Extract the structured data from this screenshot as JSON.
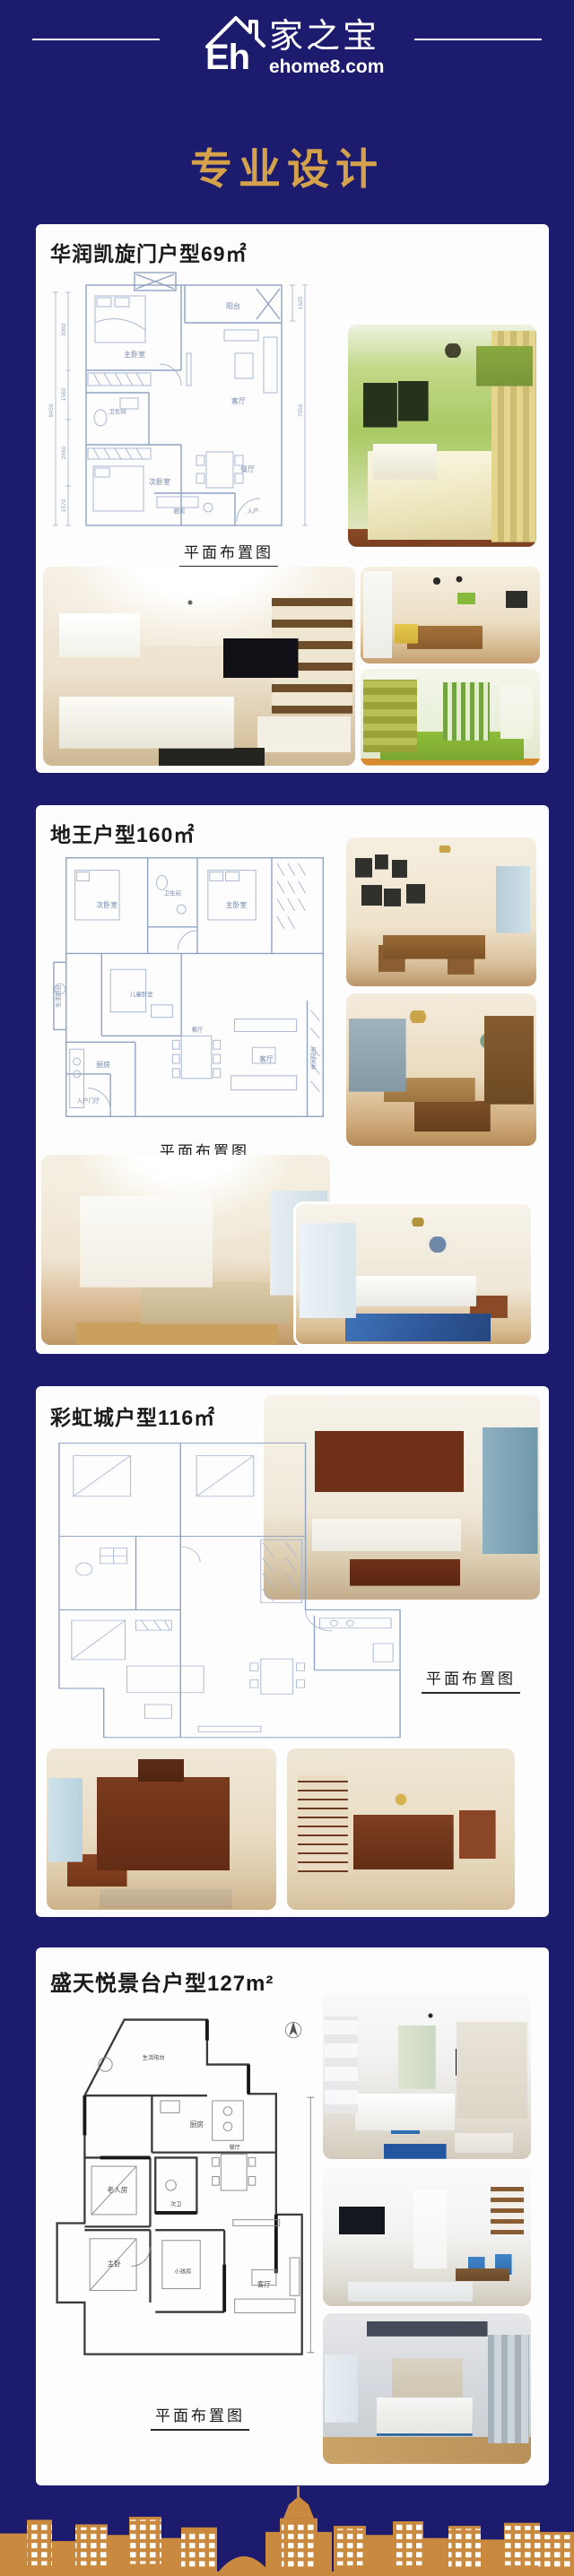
{
  "theme": {
    "bg": "#1c1b6e",
    "gold": "#d3a24b",
    "card": "#fdfdfe",
    "ink": "#1a1a1a",
    "plan": "#8fa2c2",
    "plan_ink": "#7487ab",
    "skyline": "#c9893e",
    "white": "#ffffff"
  },
  "header": {
    "roof_icon": "house-roof-icon",
    "brand_initials": "Eh",
    "brand_name": "家之宝",
    "brand_domain": "ehome8.com"
  },
  "page_title": "专业设计",
  "sections": [
    {
      "title": "华润凯旋门户型69㎡",
      "caption": "平面布置图",
      "plan_rooms": [
        "阳台",
        "主卧室",
        "客厅",
        "卫生间",
        "次卧室",
        "餐厅",
        "厨房",
        "入户"
      ],
      "plan_dims": [
        "9450",
        "3080",
        "1560",
        "2460",
        "1570",
        "1620",
        "7950"
      ],
      "photos": [
        "green-country-bedroom",
        "beige-living-room",
        "wood-dining-area",
        "green-study-room"
      ]
    },
    {
      "title": "地王户型160㎡",
      "caption": "平面布置图",
      "plan_rooms": [
        "次卧室",
        "卫生间",
        "主卧室",
        "儿童卧室",
        "生活阳台",
        "厨房",
        "餐厅",
        "客厅",
        "入户门厅",
        "休闲阳台"
      ],
      "photos": [
        "gallery-wall-dining",
        "wood-kitchen-dining",
        "cream-living-room",
        "blue-rug-lounge"
      ]
    },
    {
      "title": "彩虹城户型116㎡",
      "caption": "平面布置图",
      "plan_rooms": [],
      "photos": [
        "chinese-living-room",
        "redwood-tv-room",
        "redwood-dining-room"
      ]
    },
    {
      "title": "盛天悦景台户型127m²",
      "caption": "平面布置图",
      "plan_rooms": [
        "生活阳台",
        "厨房",
        "老人房",
        "次卫",
        "餐厅",
        "主卧",
        "小孩房",
        "客厅"
      ],
      "photos": [
        "modern-blue-living",
        "blue-chair-dining-hall",
        "blue-grey-bedroom"
      ]
    }
  ],
  "footer": {
    "skyline_icon": "city-skyline-silhouette"
  }
}
